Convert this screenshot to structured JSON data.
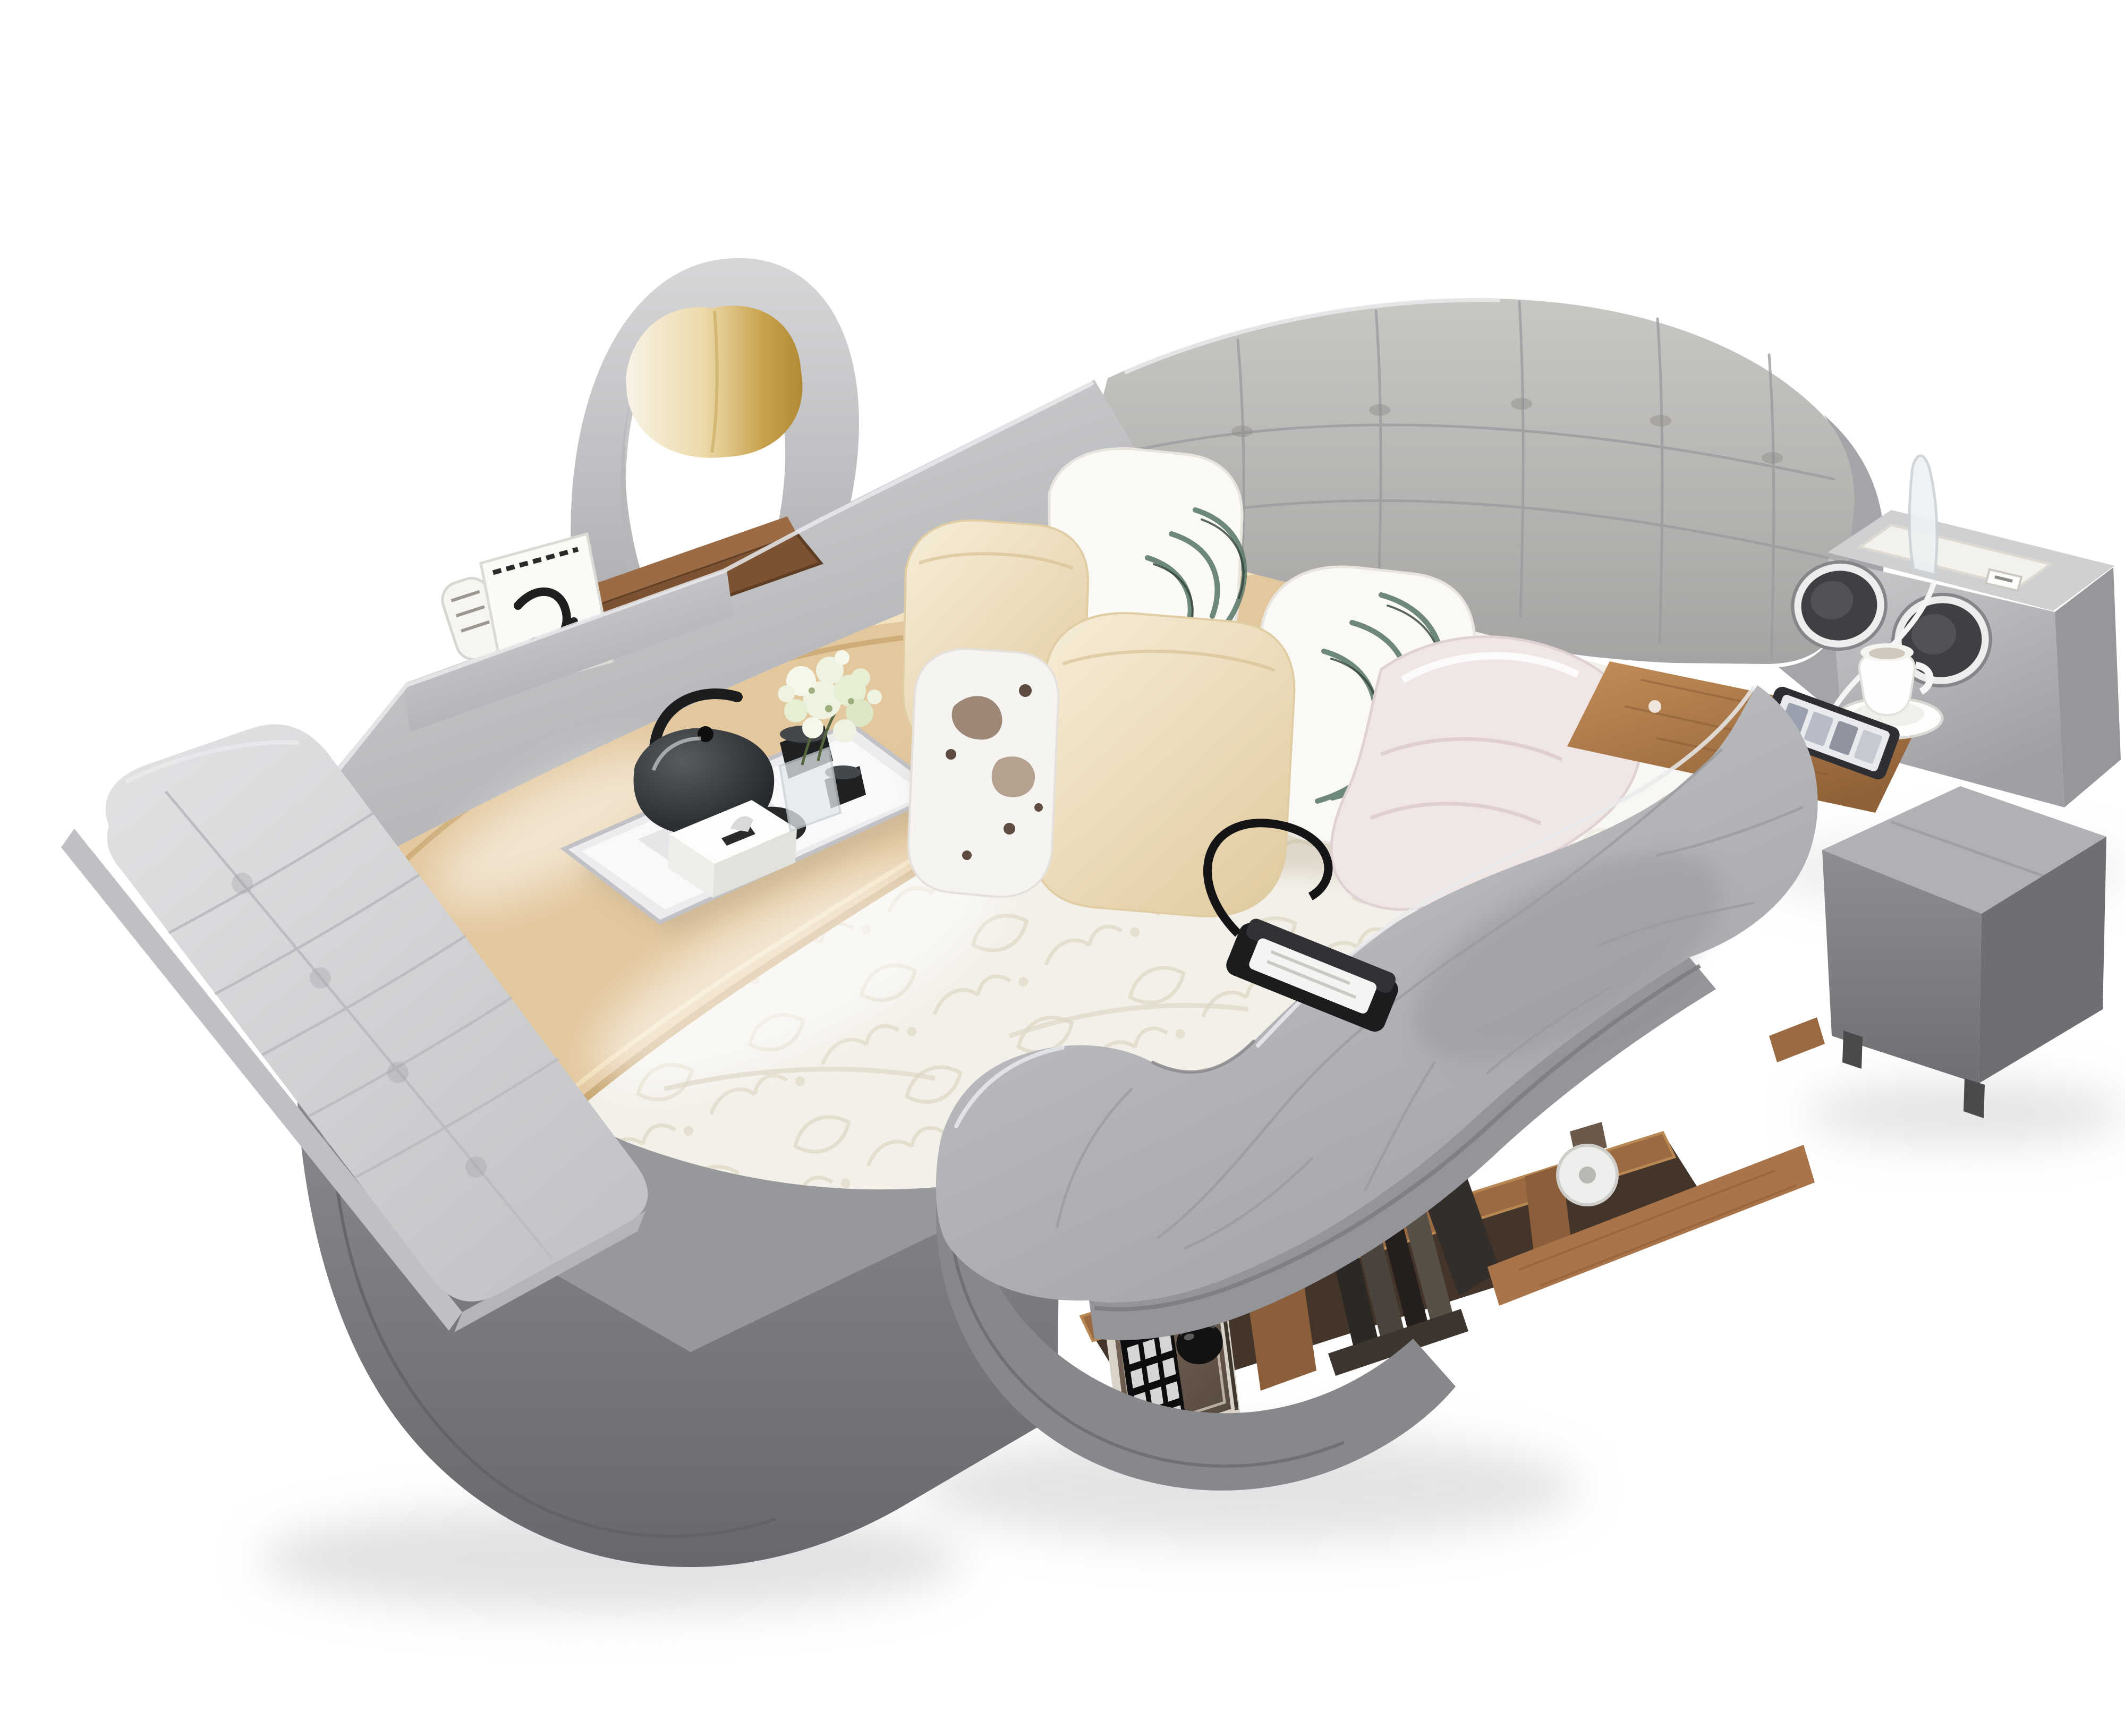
{
  "meta": {
    "type": "product-photograph",
    "subject": "Gray multifunctional smart bed with massage chaise, audio console, storage shelf and safe"
  },
  "scene": {
    "title": "Multifunctional smart bed",
    "alt": "Studio photo on a white background of a large gray leather platform smart bed: a tufted headboard with zebra-leaf and cream pillows, a curved lounge chair with a gold accent pillow behind the head rail, a side rail with a storage compartment holding a magazine and a wooden organizer, a beige wooden runner across a white patterned duvet carrying a mirrored serving tray with a black glass tea set, tissue box and baby's-breath flowers, a right-hand audio console with two chrome speakers, acrylic reading lamp, USB dock and charging cable above a wooden side table with a coffee cup and smartphone, an integrated S-curved massage chaise with a black remote, an under-chaise wooden shelf containing books and an electronic keypad safe with a caster wheel, a gray cube ottoman, and a long tufted bench cushion on the dark gray platform.",
    "background": "#ffffff"
  },
  "palette": {
    "background": "#ffffff",
    "leather_light": "#c9cacc",
    "leather_mid": "#b3b4b7",
    "leather_dark": "#909195",
    "platform": "#7d7e82",
    "platform_deck": "#97989b",
    "bench": "#d9dadc",
    "headboard": "#bcbab7",
    "cream_pillow": "#f1e5cb",
    "gold_pillow": "#c9a24e",
    "leaf_print": "#5f7d6e",
    "white_fabric": "#f6f3ee",
    "duvet": "#f3f0e9",
    "runner": "#e3c89e",
    "wood": "#a9744a",
    "wood_light": "#c08b56",
    "tray": "#f2f2f4",
    "black": "#1b1c1e",
    "chrome": "#ecedef",
    "safe_face": "#6f5f52",
    "safe_frame": "#d8d2c8",
    "key": "#d6d6d4",
    "pink_satin": "#f0e6e6",
    "flower": "#eef2e1",
    "phone": "#2e2f33"
  },
  "objects": [
    {
      "id": "armchair",
      "label": "curved lounge chair",
      "desc": "gray crescent-back chair behind the head rail"
    },
    {
      "id": "accent-pillow",
      "label": "gold accent pillow",
      "desc": "white-to-gold satin cushion on the chair"
    },
    {
      "id": "head-rail",
      "label": "upholstered head rail",
      "desc": "angled gray rail with built-in storage compartment"
    },
    {
      "id": "magazine",
      "label": "magazine",
      "desc": "white magazine with black graphic in the rail compartment"
    },
    {
      "id": "organizer",
      "label": "wooden organizer box",
      "desc": "brown open box inside the rail compartment"
    },
    {
      "id": "headboard",
      "label": "tufted headboard",
      "desc": "wide gray biscuit-tufted headboard"
    },
    {
      "id": "leaf-pillows",
      "label": "leaf print pillows",
      "desc": "two white pillows with teal zebra-leaf print"
    },
    {
      "id": "cream-pillows",
      "label": "cream pillows",
      "desc": "two plain cream cushions"
    },
    {
      "id": "print-pillow",
      "label": "printed accent pillow",
      "desc": "small white pillow with brown abstract print"
    },
    {
      "id": "duvet-roll",
      "label": "satin duvet roll",
      "desc": "pale pink-white rolled duvet beside the pillows"
    },
    {
      "id": "mattress",
      "label": "mattress with patterned duvet",
      "desc": "glossy white quatrefoil-patterned bedding"
    },
    {
      "id": "runner",
      "label": "bed runner",
      "desc": "beige wooden-tone runner band across the bed"
    },
    {
      "id": "serving-tray",
      "label": "mirrored serving tray",
      "desc": "silver tray with tea set"
    },
    {
      "id": "teapot",
      "label": "black glass teapot",
      "desc": "dark glass teapot with loop handle"
    },
    {
      "id": "teacups",
      "label": "black teacups",
      "desc": "two small dark cups and folded napkin"
    },
    {
      "id": "tissue-box",
      "label": "tissue box",
      "desc": "white tissue box on the tray"
    },
    {
      "id": "vase-flowers",
      "label": "vase with baby's breath",
      "desc": "glass vase with white flower cluster"
    },
    {
      "id": "toiletry-jar",
      "label": "toiletry jar",
      "desc": "small white jar with beige label on the duvet"
    },
    {
      "id": "audio-console",
      "label": "audio console",
      "desc": "gray corner unit with two chrome-ringed speakers"
    },
    {
      "id": "reading-lamp",
      "label": "acrylic reading lamp",
      "desc": "clear blade lamp on the console top panel"
    },
    {
      "id": "usb-dock",
      "label": "USB charging dock",
      "desc": "white recessed charging panel with port"
    },
    {
      "id": "charging-cable",
      "label": "charging cable",
      "desc": "white cable running from console to smartphone"
    },
    {
      "id": "side-table",
      "label": "wooden side table",
      "desc": "walnut tray surface beside the console"
    },
    {
      "id": "coffee-cup",
      "label": "coffee cup and saucer",
      "desc": "white cup on saucer on the side table"
    },
    {
      "id": "smartphone",
      "label": "smartphone",
      "desc": "phone lying on the side table"
    },
    {
      "id": "chaise",
      "label": "massage chaise lounge",
      "desc": "S-curved gray recliner integrated into the bed"
    },
    {
      "id": "remote",
      "label": "massage remote",
      "desc": "black handset with white display and strap on the chaise"
    },
    {
      "id": "storage-shelf",
      "label": "under-chaise storage shelf",
      "desc": "open wooden shelf below the chaise"
    },
    {
      "id": "books",
      "label": "books",
      "desc": "pile of dark books in the middle cubby"
    },
    {
      "id": "safe",
      "label": "electronic safe",
      "desc": "keypad safe with black dial in the left cubby"
    },
    {
      "id": "caster",
      "label": "caster wheel",
      "desc": "white roller wheel under the chaise"
    },
    {
      "id": "ottoman",
      "label": "cube ottoman",
      "desc": "dark gray upholstered ottoman at lower right"
    },
    {
      "id": "bench",
      "label": "tufted bench cushion",
      "desc": "long light-gray tufted cushion along the left side"
    },
    {
      "id": "platform",
      "label": "bed platform",
      "desc": "dark gray rounded platform base"
    }
  ]
}
